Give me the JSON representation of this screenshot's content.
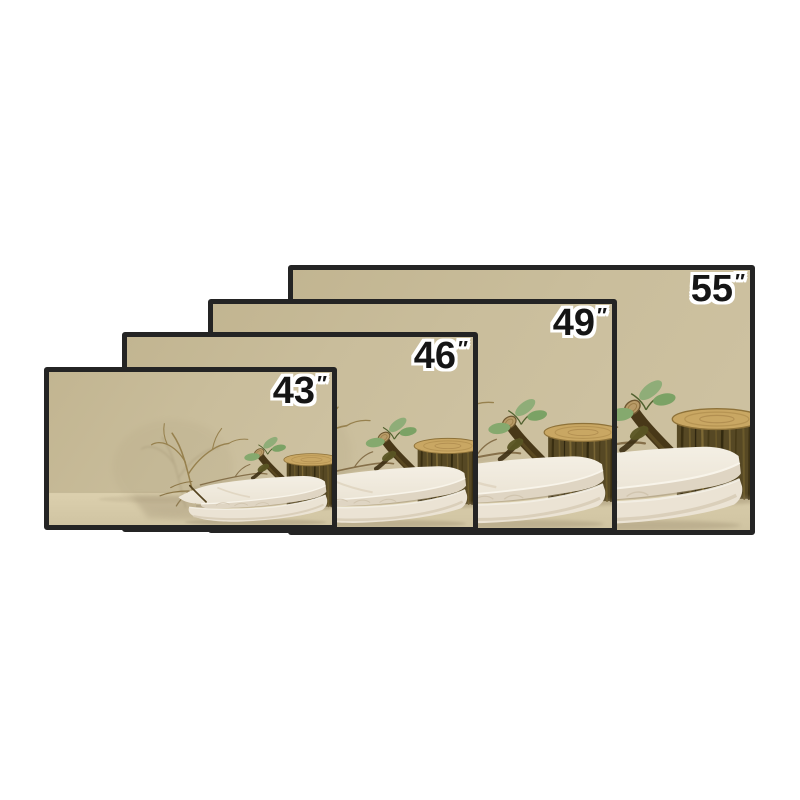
{
  "page": {
    "background_color": "#ffffff"
  },
  "size_chart": {
    "frame_color": "#242424",
    "label_color": "#151515",
    "label_outline_color": "#ffffff",
    "panels": [
      {
        "size": "55",
        "unit": "″",
        "geometry": {
          "left": 288,
          "top": 265,
          "width": 467,
          "height": 270
        }
      },
      {
        "size": "49",
        "unit": "″",
        "geometry": {
          "left": 208,
          "top": 299,
          "width": 409,
          "height": 234
        }
      },
      {
        "size": "46",
        "unit": "″",
        "geometry": {
          "left": 122,
          "top": 332,
          "width": 356,
          "height": 200
        }
      },
      {
        "size": "43",
        "unit": "″",
        "geometry": {
          "left": 44,
          "top": 367,
          "width": 293,
          "height": 163
        }
      }
    ]
  },
  "scene": {
    "name": "beige-podium-product-scene",
    "elements": [
      "dry twig branches",
      "cut branch with green leaves",
      "bark log stump",
      "two stacked white stone slabs",
      "soft floor shadow"
    ],
    "colors": {
      "wall": "#c9bd9b",
      "floor": "#d6caa8",
      "slab_light": "#f2ecdf",
      "slab_shade": "#dfd5c3",
      "bark_dark": "#564824",
      "wood_top": "#c9a763",
      "leaf_green": "#85a96e",
      "twig_brown": "#97814e",
      "shadow": "#95866a"
    }
  }
}
